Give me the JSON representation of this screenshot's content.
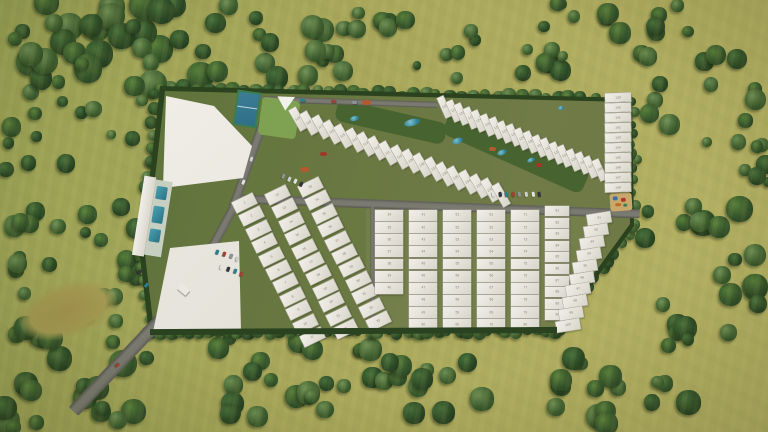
{
  "scene": {
    "type": "aerial-3d-masterplan-render",
    "description": "Top-down render of a gated residential villa community with numbered plots, amenity zones, internal roads and parking, surrounded by olive-green fields with tree clusters",
    "features": [
      "clubhouse",
      "sports-court",
      "canopy-structure",
      "swimming-pool",
      "lap-pool-amenity",
      "linear-park",
      "water-features",
      "playground",
      "parking-bays",
      "entry-road",
      "gatehouse",
      "villa-plots",
      "boundary-hedge",
      "grass-field",
      "tree-clusters",
      "dirt-patch"
    ]
  },
  "colors": {
    "field": "#a9a75a",
    "field_light": "#b4b164",
    "tree": "#2f4d26",
    "site_green": "#66763f",
    "park_green": "#47632f",
    "road": "#78786f",
    "plot": "#ebe8e1",
    "plot_number": "#8a8578",
    "water": "#2e7d92",
    "court": "#2e6f88",
    "accent_orange": "#b35a2e",
    "accent_red": "#a03828",
    "playground_sand": "#c9a96b",
    "car_colors": [
      "#e3e3df",
      "#33363c",
      "#2e7f8c",
      "#9c4434",
      "#8e9196",
      "#cdd0cc"
    ]
  },
  "plots": {
    "bottom_left_rows": [
      [
        1,
        2,
        3,
        4,
        5,
        6,
        7,
        8,
        9,
        10,
        11
      ],
      [
        12,
        13,
        14,
        15,
        16,
        17,
        18,
        19,
        20,
        21,
        22
      ],
      [
        23,
        24,
        25,
        26,
        27,
        28,
        29,
        30,
        31,
        32,
        33
      ]
    ],
    "grid_columns": [
      [
        34,
        35,
        36,
        37,
        38,
        39,
        40
      ],
      [
        41,
        42,
        43,
        44,
        45,
        46,
        47,
        48,
        49,
        50
      ],
      [
        51,
        52,
        53,
        54,
        55,
        56,
        57,
        58,
        59,
        60
      ],
      [
        61,
        62,
        63,
        64,
        65,
        66,
        67,
        68,
        69,
        70
      ],
      [
        71,
        72,
        73,
        74,
        75,
        76,
        77,
        78,
        79,
        80
      ],
      [
        81,
        82,
        83,
        84,
        85,
        86,
        87,
        88,
        89,
        90
      ]
    ],
    "grid_edge_column": [
      91,
      92,
      93,
      94,
      95,
      96,
      97,
      98,
      99,
      100
    ],
    "villa_band_lower": [
      119,
      118,
      117,
      116,
      115,
      114,
      113,
      112,
      111,
      110,
      109,
      108,
      107,
      106,
      105,
      104,
      103,
      102,
      101
    ],
    "villa_band_upper": [
      120,
      121,
      122,
      123,
      124,
      125,
      126,
      127,
      128,
      129,
      130,
      131,
      132,
      133,
      134,
      135,
      136,
      137,
      138
    ],
    "right_column": [
      139,
      140,
      141,
      142,
      143,
      144,
      145,
      146,
      147,
      148
    ]
  }
}
